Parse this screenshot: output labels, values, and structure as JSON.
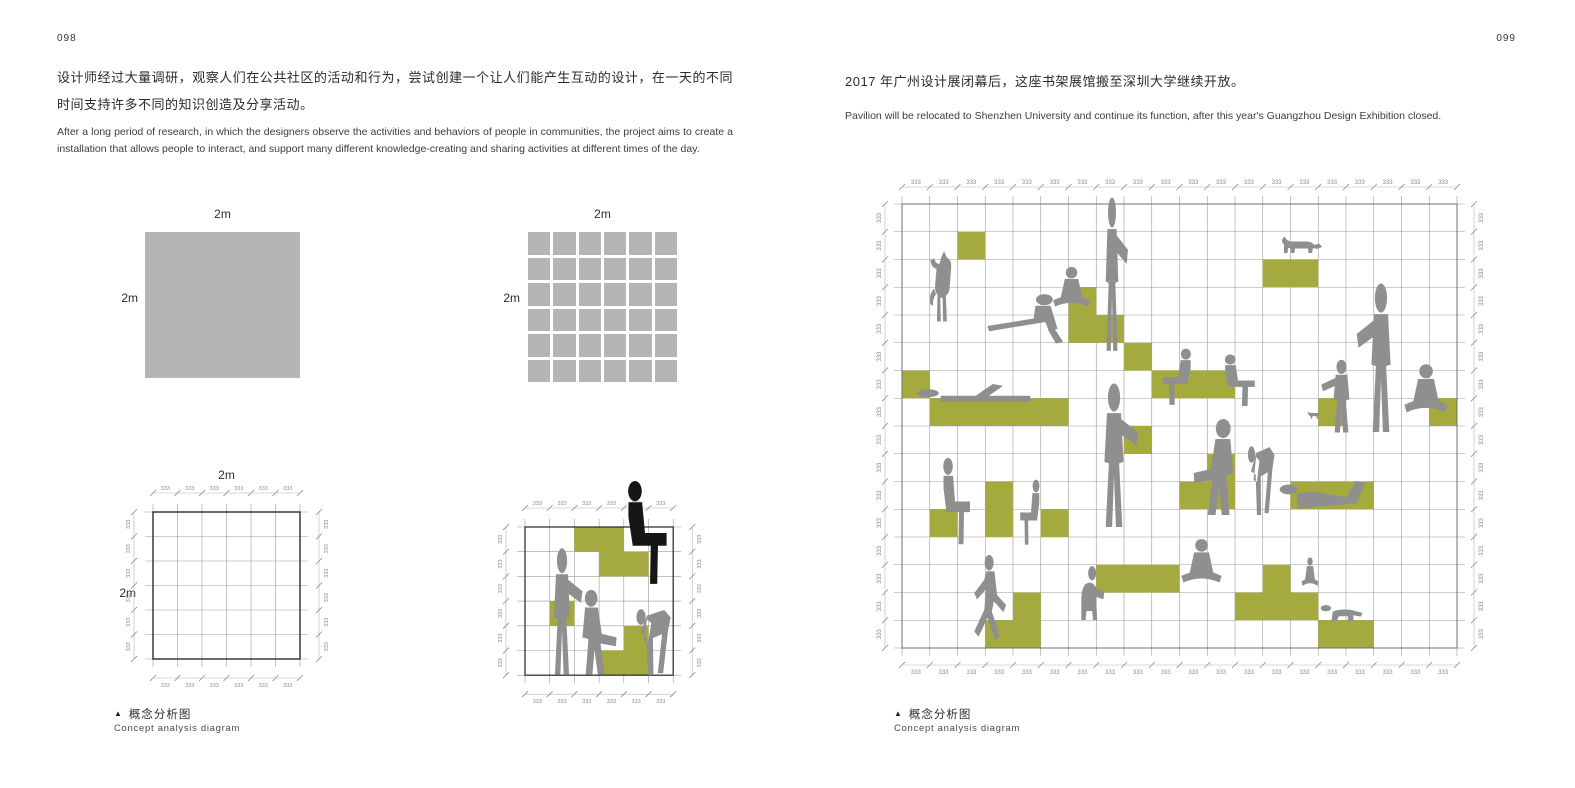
{
  "colors": {
    "green": "#a5aa3e",
    "figure_gray": "#8f8f8f",
    "figure_black": "#161616",
    "square_gray": "#b5b5b5",
    "grid_line": "#9a9a9a",
    "dim_line": "#b5b5b5",
    "dim_text": "#8c8c8c",
    "border_dark": "#2a2a2a",
    "border_gray": "#6f6f6f"
  },
  "left_page": {
    "page_number": "098",
    "paragraph_zh": "设计师经过大量调研，观察人们在公共社区的活动和行为，尝试创建一个让人们能产生互动的设计，在一天的不同时间支持许多不同的知识创造及分享活动。",
    "paragraph_en": "After a long period of research, in which the designers observe the activities and behaviors of people in communities, the project aims to create a installation that allows people to interact, and support many different knowledge-creating and sharing activities at different times of the day.",
    "caption_marker": "▲",
    "caption_zh": "概念分析图",
    "caption_en": "Concept analysis diagram",
    "solid_square_label_top": "2m",
    "solid_square_label_left": "2m",
    "grid_square_label_top": "2m",
    "grid_square_label_left": "2m",
    "outline_square_label_top": "2m",
    "outline_square_label_left": "2m"
  },
  "right_page": {
    "page_number": "099",
    "paragraph_zh": "2017 年广州设计展闭幕后，这座书架展馆搬至深圳大学继续开放。",
    "paragraph_en": "Pavilion will be relocated to Shenzhen University and continue its function, after this year's Guangzhou Design Exhibition closed.",
    "caption_marker": "▲",
    "caption_zh": "概念分析图",
    "caption_en": "Concept analysis diagram"
  },
  "diagrams": {
    "grid_square": {
      "rows": 6,
      "cols": 6,
      "gap": 3
    },
    "outline_square": {
      "cols": 6,
      "rows": 6,
      "cell": 24.5,
      "origin": [
        48,
        57
      ],
      "ext": 8,
      "dim_offset": 19,
      "tick": "333",
      "border": "#2a2a2a",
      "border_w": 1.4,
      "green_cells": [],
      "figures": []
    },
    "concept_small": {
      "cols": 6,
      "rows": 6,
      "cell": 24.7,
      "origin": [
        47,
        72
      ],
      "ext": 8,
      "dim_offset": 19,
      "tick": "333",
      "border": "#333333",
      "border_w": 1.3,
      "green_cells": [
        [
          2,
          0
        ],
        [
          3,
          0
        ],
        [
          3,
          1
        ],
        [
          4,
          1
        ],
        [
          1,
          3
        ],
        [
          4,
          4
        ],
        [
          3,
          5
        ],
        [
          4,
          5
        ]
      ],
      "figures": [
        {
          "glyph": "person-sit-block",
          "x": 131,
          "y": 25,
          "w": 72,
          "h": 106,
          "flip": false,
          "color": "black"
        },
        {
          "glyph": "person-standing-arm",
          "x": 57,
          "y": 92,
          "w": 54,
          "h": 130,
          "flip": false,
          "color": "gray"
        },
        {
          "glyph": "person-sit-knees",
          "x": 91,
          "y": 134,
          "w": 67,
          "h": 88,
          "flip": false,
          "color": "gray"
        },
        {
          "glyph": "person-bend",
          "x": 156,
          "y": 129,
          "w": 54,
          "h": 93,
          "flip": false,
          "color": "gray"
        }
      ]
    },
    "concept_large": {
      "cols": 20,
      "rows": 16,
      "cell": 27.75,
      "origin": [
        57,
        44
      ],
      "ext": 8,
      "dim_offset": 17,
      "tick": "333",
      "border": "#6f6f6f",
      "border_w": 1,
      "green_cells": [
        [
          2,
          1
        ],
        [
          13,
          2
        ],
        [
          14,
          2
        ],
        [
          6,
          3
        ],
        [
          6,
          4
        ],
        [
          7,
          4
        ],
        [
          8,
          5
        ],
        [
          0,
          6
        ],
        [
          9,
          6
        ],
        [
          10,
          6
        ],
        [
          11,
          6
        ],
        [
          1,
          7
        ],
        [
          2,
          7
        ],
        [
          3,
          7
        ],
        [
          4,
          7
        ],
        [
          5,
          7
        ],
        [
          15,
          7
        ],
        [
          19,
          7
        ],
        [
          8,
          8
        ],
        [
          11,
          9
        ],
        [
          3,
          10
        ],
        [
          10,
          10
        ],
        [
          11,
          10
        ],
        [
          14,
          10
        ],
        [
          15,
          10
        ],
        [
          16,
          10
        ],
        [
          1,
          11
        ],
        [
          3,
          11
        ],
        [
          5,
          11
        ],
        [
          7,
          13
        ],
        [
          8,
          13
        ],
        [
          9,
          13
        ],
        [
          13,
          13
        ],
        [
          4,
          14
        ],
        [
          12,
          14
        ],
        [
          13,
          14
        ],
        [
          14,
          14
        ],
        [
          3,
          15
        ],
        [
          4,
          15
        ],
        [
          15,
          15
        ],
        [
          16,
          15
        ]
      ],
      "figures": [
        {
          "glyph": "cat-climb",
          "x": 76,
          "y": 91,
          "w": 47,
          "h": 72,
          "flip": false,
          "color": "gray"
        },
        {
          "glyph": "person-reclined",
          "x": 137,
          "y": 133,
          "w": 89,
          "h": 58,
          "flip": false,
          "color": "gray"
        },
        {
          "glyph": "person-cross-legged",
          "x": 196,
          "y": 105,
          "w": 61,
          "h": 61,
          "flip": false,
          "color": "gray"
        },
        {
          "glyph": "person-standing-arm",
          "x": 246,
          "y": 36,
          "w": 42,
          "h": 158,
          "flip": false,
          "color": "gray"
        },
        {
          "glyph": "person-sit-block",
          "x": 307,
          "y": 188,
          "w": 53,
          "h": 58,
          "flip": true,
          "color": "gray"
        },
        {
          "glyph": "person-sit-block",
          "x": 365,
          "y": 194,
          "w": 56,
          "h": 53,
          "flip": false,
          "color": "gray"
        },
        {
          "glyph": "cat-walk",
          "x": 434,
          "y": 70,
          "w": 50,
          "h": 37,
          "flip": false,
          "color": "gray"
        },
        {
          "glyph": "person-lying-back",
          "x": 71,
          "y": 201,
          "w": 130,
          "h": 47,
          "flip": false,
          "color": "gray"
        },
        {
          "glyph": "person-standing-arm",
          "x": 237,
          "y": 222,
          "w": 64,
          "h": 148,
          "flip": false,
          "color": "gray"
        },
        {
          "glyph": "person-sit-knees",
          "x": 326,
          "y": 258,
          "w": 78,
          "h": 100,
          "flip": true,
          "color": "gray"
        },
        {
          "glyph": "person-bend",
          "x": 401,
          "y": 260,
          "w": 42,
          "h": 97,
          "flip": false,
          "color": "gray"
        },
        {
          "glyph": "person-lying-front",
          "x": 432,
          "y": 299,
          "w": 105,
          "h": 58,
          "flip": false,
          "color": "gray"
        },
        {
          "glyph": "person-sit-block",
          "x": 85,
          "y": 297,
          "w": 50,
          "h": 89,
          "flip": false,
          "color": "gray"
        },
        {
          "glyph": "person-sit-block",
          "x": 168,
          "y": 319,
          "w": 36,
          "h": 67,
          "flip": true,
          "color": "gray"
        },
        {
          "glyph": "person-running",
          "x": 115,
          "y": 394,
          "w": 53,
          "h": 91,
          "flip": false,
          "color": "gray"
        },
        {
          "glyph": "person-crouch",
          "x": 218,
          "y": 402,
          "w": 47,
          "h": 83,
          "flip": false,
          "color": "gray"
        },
        {
          "glyph": "person-cross-legged",
          "x": 323,
          "y": 377,
          "w": 67,
          "h": 67,
          "flip": false,
          "color": "gray"
        },
        {
          "glyph": "person-cross-legged",
          "x": 451,
          "y": 396,
          "w": 28,
          "h": 44,
          "flip": false,
          "color": "gray"
        },
        {
          "glyph": "baby-crawl",
          "x": 473,
          "y": 430,
          "w": 61,
          "h": 36,
          "flip": false,
          "color": "gray"
        },
        {
          "glyph": "person-standing-arm",
          "x": 470,
          "y": 199,
          "w": 53,
          "h": 75,
          "flip": true,
          "color": "gray"
        },
        {
          "glyph": "dog-small",
          "x": 461,
          "y": 248,
          "w": 24,
          "h": 18,
          "flip": false,
          "color": "gray"
        },
        {
          "glyph": "person-standing-arm",
          "x": 504,
          "y": 122,
          "w": 64,
          "h": 153,
          "flip": true,
          "color": "gray"
        },
        {
          "glyph": "person-cross-legged",
          "x": 545,
          "y": 202,
          "w": 72,
          "h": 74,
          "flip": false,
          "color": "gray"
        }
      ]
    }
  }
}
